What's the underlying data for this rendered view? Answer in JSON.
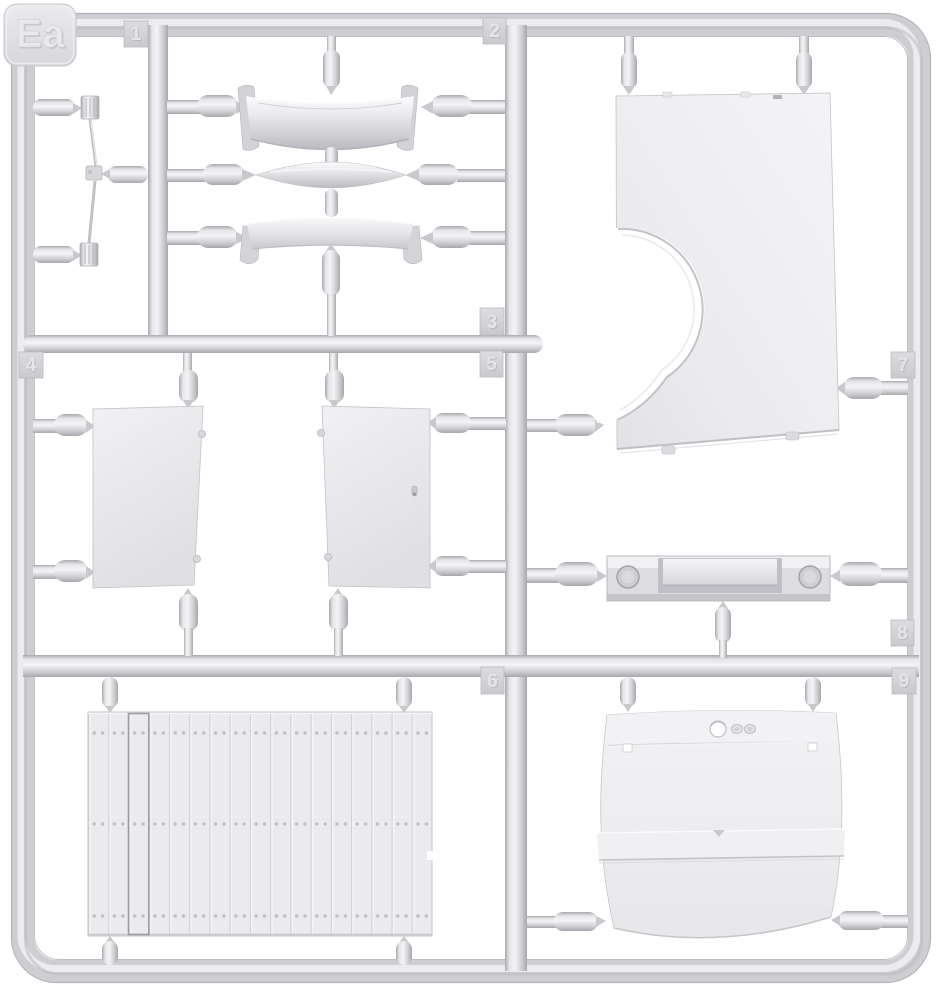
{
  "sprue": {
    "label": "Ea",
    "part_numbers": [
      "1",
      "2",
      "3",
      "4",
      "5",
      "6",
      "7",
      "8",
      "9"
    ]
  },
  "colors": {
    "background": "#ffffff",
    "plastic_mid": "#d0d0d5",
    "plastic_light": "#f3f3f5",
    "plastic_dark": "#a8a8ae",
    "part_surface": "#ededf0",
    "tag_plate": "#d6d6da",
    "embossed_text": "#e6e6e9"
  }
}
